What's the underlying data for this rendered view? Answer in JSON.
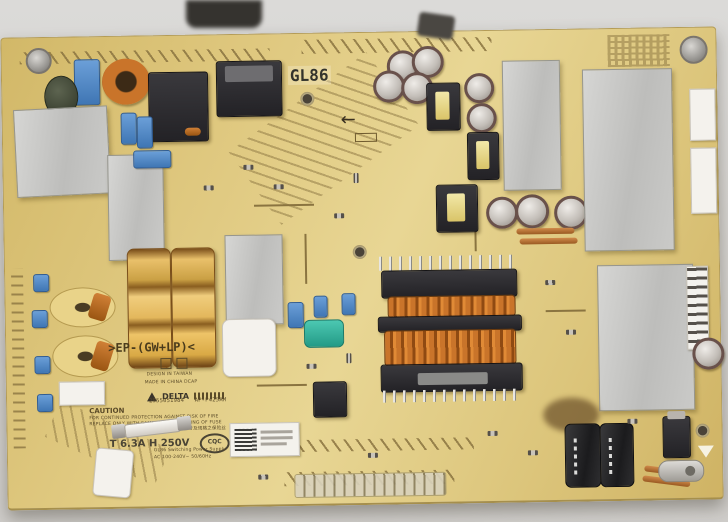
{
  "photo": {
    "subject": "TV switching power supply circuit board photographed on a gray surface"
  },
  "colors": {
    "backdrop": "#d8d6d3",
    "board": "#ddc67c",
    "copper_winding": "#b5641c",
    "heatsink": "#c4c4c2",
    "film_cap_blue": "#4a84c4",
    "film_cap_teal": "#2fae9b",
    "gold_capacitor": "#d9a945"
  },
  "silkscreen": {
    "model_badge": "GL86",
    "ep_marking": ">EP-(GW+LP)<",
    "design_line": "DESIGN IN TAIWAN",
    "origin_line": "MADE IN CHINA DCAP",
    "brand": "DELTA",
    "part_number": "2955051984",
    "board_id": "AP-P425AM",
    "arrow_left": "←"
  },
  "caution": {
    "title": "CAUTION",
    "line1": "FOR CONTINUED PROTECTION AGAINST RISK OF FIRE",
    "line2": "REPLACE ONLY WITH SAME TYPE AND RATING OF FUSE",
    "line3": "更换保险丝时须用同型号及规格之保险丝"
  },
  "fuse": {
    "rating": "T 6.3A H 250V"
  },
  "certification": {
    "cqc": "CQC"
  },
  "spec": {
    "line1": "GL86 Switching Power Supply",
    "line2": "AC 100-240V~ 50/60Hz"
  }
}
